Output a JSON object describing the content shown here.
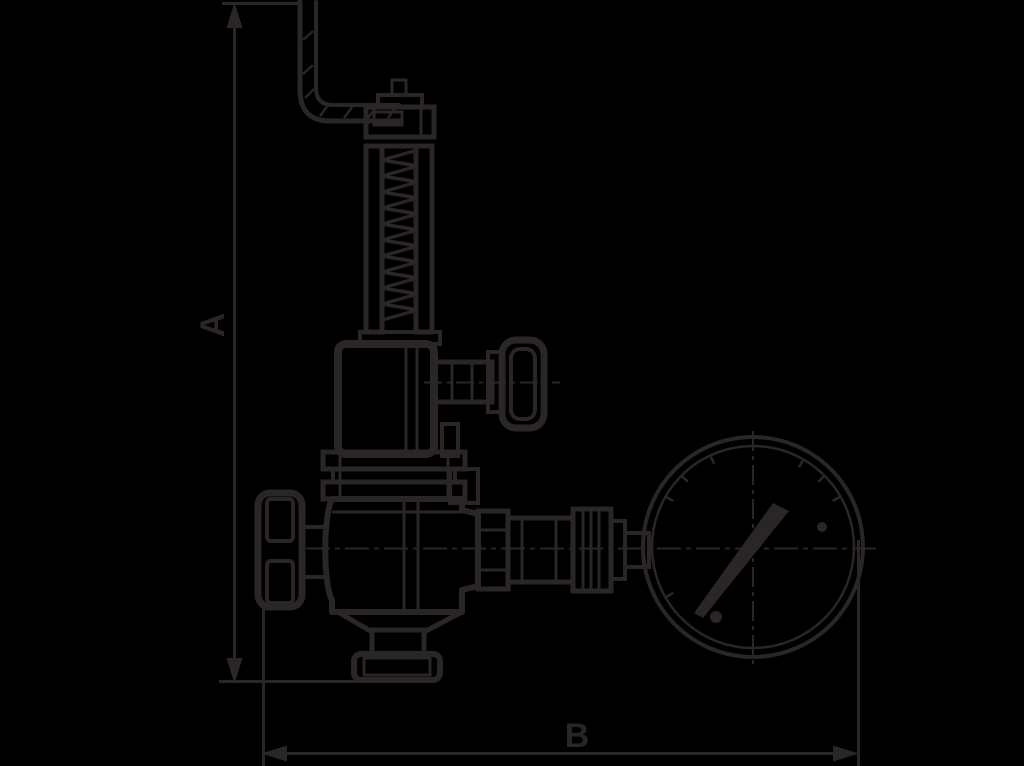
{
  "canvas": {
    "width": 1024,
    "height": 766,
    "background": "#000000",
    "ink": "#2a2526"
  },
  "dimensions": {
    "a_label": "A",
    "b_label": "B"
  }
}
